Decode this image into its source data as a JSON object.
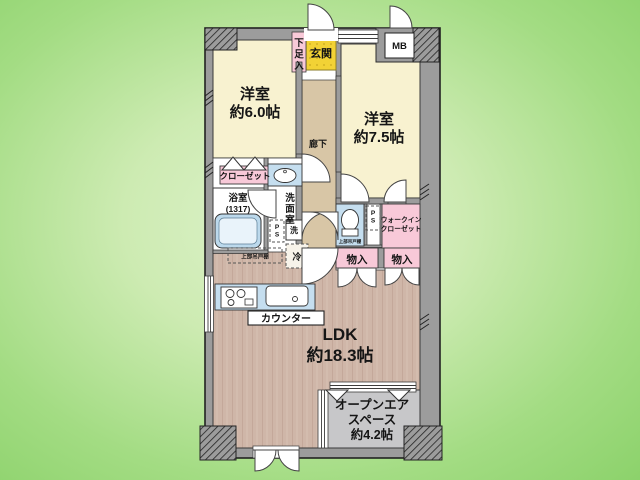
{
  "colors": {
    "background_center": "#ddf2cb",
    "background_edge": "#8cd26b",
    "wall_gray": "#9c9c9c",
    "room_cream": "#f8f2d0",
    "entrance_yellow": "#f2d235",
    "closet_pink": "#f8c9d8",
    "corridor_tan": "#d8c6a6",
    "ldk_wood": "#cfb6a8",
    "fixture_blue": "#c5deef",
    "open_air_gray": "#c7c7c9",
    "room_white": "#ffffff"
  },
  "rooms": {
    "bedroom1": {
      "name": "洋室",
      "size": "約6.0帖"
    },
    "bedroom2": {
      "name": "洋室",
      "size": "約7.5帖"
    },
    "ldk": {
      "name": "LDK",
      "size": "約18.3帖"
    },
    "open_air_space": {
      "line1": "オープンエア",
      "line2": "スペース",
      "line3": "約4.2帖"
    },
    "entrance": {
      "label": "玄関"
    },
    "corridor": {
      "label": "廊下"
    },
    "bathroom": {
      "name": "浴室",
      "size": "(1317)"
    },
    "washroom": {
      "label": "洗面室"
    },
    "walk_in_closet": {
      "line1": "ウォークイン",
      "line2": "クローゼット"
    }
  },
  "fixtures": {
    "shoe_cabinet": "下足入",
    "meter_box": "MB",
    "closet": "クローゼット",
    "washer": "洗",
    "pipe_space": "PS",
    "pipe_space2": "PS",
    "refrigerator": "冷",
    "upper_cabinet": "上部吊戸棚",
    "toilet_upper_cabinet": "上部吊戸棚",
    "storage1": "物入",
    "storage2": "物入",
    "counter": "カウンター"
  }
}
